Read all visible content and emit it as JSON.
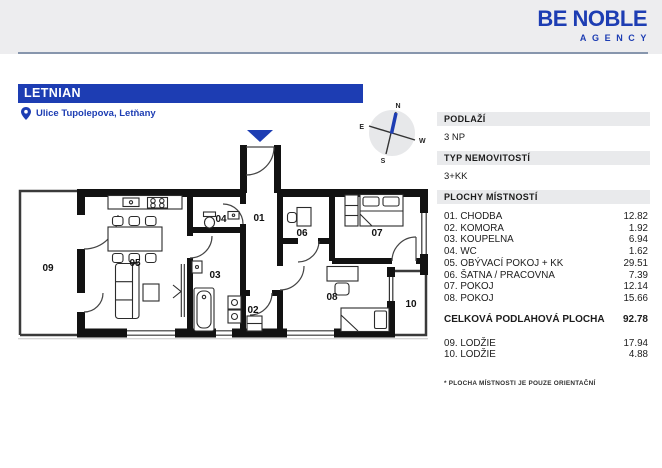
{
  "colors": {
    "accent": "#1d3db3",
    "header_band": "#ededef",
    "divider_line": "#8796ad",
    "section_bar": "#e9eaec",
    "wall": "#121212"
  },
  "header": {
    "brand_line1": "BE NOBLE",
    "brand_line2": "AGENCY"
  },
  "listing": {
    "title": "LETNIAN",
    "address": "Ulice Tupolepova, Letňany"
  },
  "compass": {
    "n": "N",
    "e": "E",
    "s": "S",
    "w": "W"
  },
  "floorplan": {
    "labels": {
      "r01": "01",
      "r02": "02",
      "r03": "03",
      "r04": "04",
      "r05": "05",
      "r06": "06",
      "r07": "07",
      "r08": "08",
      "r09": "09",
      "r10": "10"
    }
  },
  "panel": {
    "floor_label": "PODLAŽÍ",
    "floor_value": "3 NP",
    "type_label": "TYP NEMOVITOSTÍ",
    "type_value": "3+KK",
    "rooms_label": "PLOCHY MÍSTNOSTÍ",
    "rooms": [
      {
        "name": "01. CHODBA",
        "area": "12.82"
      },
      {
        "name": "02. KOMORA",
        "area": "1.92"
      },
      {
        "name": "03. KOUPELNA",
        "area": "6.94"
      },
      {
        "name": "04. WC",
        "area": "1.62"
      },
      {
        "name": "05. OBÝVACÍ POKOJ + KK",
        "area": "29.51"
      },
      {
        "name": "06. ŠATNA / PRACOVNA",
        "area": "7.39"
      },
      {
        "name": "07. POKOJ",
        "area": "12.14"
      },
      {
        "name": "08. POKOJ",
        "area": "15.66"
      }
    ],
    "total_label": "CELKOVÁ PODLAHOVÁ PLOCHA",
    "total_value": "92.78",
    "balconies": [
      {
        "name": "09. LODŽIE",
        "area": "17.94"
      },
      {
        "name": "10. LODŽIE",
        "area": "4.88"
      }
    ],
    "footnote": "* PLOCHA MÍSTNOSTI JE POUZE ORIENTAČNÍ"
  }
}
